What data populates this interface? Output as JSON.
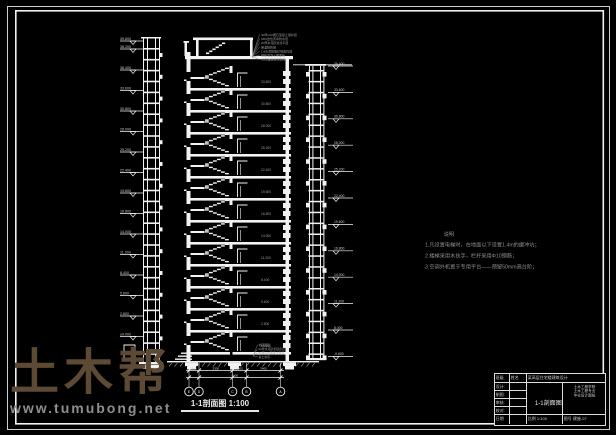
{
  "colors": {
    "line": "#f2f2f2",
    "dim_text": "#9a9a9a",
    "level_text": "#c9c9c9",
    "watermark_brand": "#5d4a35",
    "watermark_url": "#8f8f8f",
    "background": "#000000"
  },
  "watermark": {
    "brand": "土木帮",
    "url": "www.tumubong.net"
  },
  "drawing_title": {
    "full": "1-1剖面图 1:100",
    "name": "1-1剖面图",
    "scale": "1:100"
  },
  "notes": {
    "title": "说明",
    "lines": [
      "1.凡设置电梯时，在地面以下设置1.4m的缓冲坑；",
      "2.楼梯采用木扶手，栏杆采用Φ10钢筋；",
      "3.空调外机置于专用平台——预留50mm高台阶；"
    ]
  },
  "roof_callouts": [
    "40厚C20细石混凝土保护层",
    "SBS改性沥青防水层",
    "20厚水泥砂浆找平层",
    "保温隔热层",
    "1:8水泥膨胀珍珠岩找坡",
    "钢筋混凝土屋面板",
    "20厚板底抹灰刷白"
  ],
  "floor_callouts": [
    "地砖面层",
    "20厚水泥砂浆结合层",
    "80厚C15混凝土垫层",
    "素土夯实"
  ],
  "left_levels": [
    "39.600",
    "38.200",
    "36.400",
    "33.600",
    "30.800",
    "28.000",
    "25.200",
    "22.400",
    "19.600",
    "16.800",
    "14.000",
    "11.200",
    "8.400",
    "5.600",
    "2.800",
    "±0.000"
  ],
  "right_levels": [
    "36.400",
    "33.600",
    "30.800",
    "28.000",
    "25.200",
    "22.400",
    "19.600",
    "16.800",
    "14.000",
    "11.200",
    "8.400",
    "-0.600"
  ],
  "room_levels": [
    "33.600",
    "30.800",
    "28.000",
    "25.200",
    "22.400",
    "19.600",
    "16.800",
    "14.000",
    "11.200",
    "8.400",
    "5.600",
    "2.800",
    "±0.000"
  ],
  "bottom_dims": {
    "segments": [
      "900",
      "3300",
      "1400",
      "3400"
    ],
    "total": "9100"
  },
  "axis_bubbles": [
    "E",
    "D",
    "C",
    "B",
    "A"
  ],
  "titleblock": {
    "top": {
      "c1": "班级",
      "c2": "姓名",
      "c3": "某高层住宅楼建筑设计"
    },
    "rows": [
      "设计",
      "制图",
      "审核",
      "校对"
    ],
    "center": "1-1剖面图",
    "right_lines": [
      "土木工程学院",
      "土木工程专业",
      "毕业设计图纸"
    ],
    "bottom": {
      "c1": "日期",
      "c3": "比例 1:100",
      "c4": "图号 建施-07"
    }
  }
}
